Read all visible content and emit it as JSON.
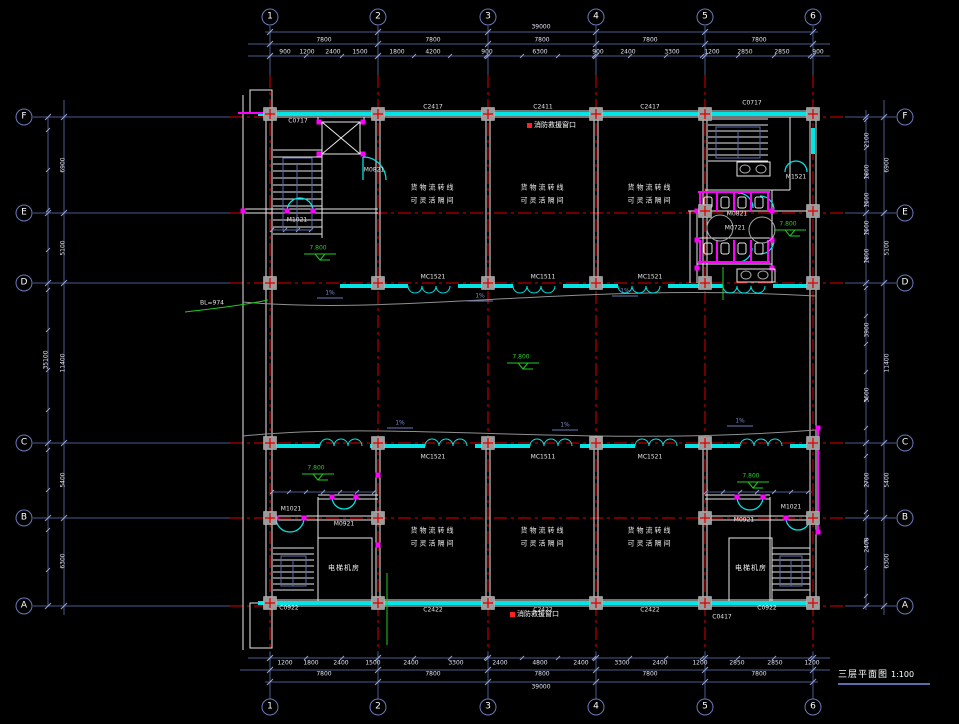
{
  "title": {
    "text": "三层平面图",
    "scale": "1:100"
  },
  "colors": {
    "background": "#000000",
    "grid_line": "#e00000",
    "wall": "#00e5e5",
    "detail": "#e8e8e8",
    "dimension": "#4a5a8e",
    "tick": "#93a3d8",
    "fixture": "#ff00ff",
    "level_mark": "#22cc22",
    "column_fill": "#9c9c9c",
    "rescue": "#ff2222",
    "rail": "#5b6dae",
    "curve": "#909090"
  },
  "grid": {
    "cols": [
      {
        "label": "1",
        "x": 270
      },
      {
        "label": "2",
        "x": 378
      },
      {
        "label": "3",
        "x": 488
      },
      {
        "label": "4",
        "x": 596
      },
      {
        "label": "5",
        "x": 705
      },
      {
        "label": "6",
        "x": 813
      }
    ],
    "rows": [
      {
        "label": "F",
        "y": 117
      },
      {
        "label": "E",
        "y": 213
      },
      {
        "label": "D",
        "y": 283
      },
      {
        "label": "C",
        "y": 443
      },
      {
        "label": "B",
        "y": 518
      },
      {
        "label": "A",
        "y": 606
      }
    ]
  },
  "rooms": [
    {
      "line1": "货物流转线",
      "line2": "可灵活隔间",
      "x": 433,
      "y": 195
    },
    {
      "line1": "货物流转线",
      "line2": "可灵活隔间",
      "x": 543,
      "y": 195
    },
    {
      "line1": "货物流转线",
      "line2": "可灵活隔间",
      "x": 650,
      "y": 195
    },
    {
      "line1": "货物流转线",
      "line2": "可灵活隔间",
      "x": 433,
      "y": 538
    },
    {
      "line1": "货物流转线",
      "line2": "可灵活隔间",
      "x": 543,
      "y": 538
    },
    {
      "line1": "货物流转线",
      "line2": "可灵活隔间",
      "x": 650,
      "y": 538
    }
  ],
  "machine_rooms": [
    {
      "t": "电梯机房",
      "x": 344,
      "y": 568
    },
    {
      "t": "电梯机房",
      "x": 751,
      "y": 568
    }
  ],
  "levels": [
    {
      "t": "7.800",
      "x": 318,
      "y": 248
    },
    {
      "t": "7.800",
      "x": 521,
      "y": 357
    },
    {
      "t": "7.800",
      "x": 788,
      "y": 224
    },
    {
      "t": "7.800",
      "x": 316,
      "y": 468
    },
    {
      "t": "7.800",
      "x": 751,
      "y": 476
    }
  ],
  "slopes": [
    {
      "t": "1%",
      "x": 330,
      "y": 293
    },
    {
      "t": "1%",
      "x": 480,
      "y": 296
    },
    {
      "t": "1%",
      "x": 625,
      "y": 291
    },
    {
      "t": "1%",
      "x": 400,
      "y": 423
    },
    {
      "t": "1%",
      "x": 565,
      "y": 425
    },
    {
      "t": "1%",
      "x": 740,
      "y": 421
    }
  ],
  "window_tags": [
    {
      "t": "C0717",
      "x": 298,
      "y": 121
    },
    {
      "t": "C2417",
      "x": 433,
      "y": 107
    },
    {
      "t": "C2411",
      "x": 543,
      "y": 107
    },
    {
      "t": "C2417",
      "x": 650,
      "y": 107
    },
    {
      "t": "C0717",
      "x": 752,
      "y": 103
    },
    {
      "t": "C0922",
      "x": 289,
      "y": 608
    },
    {
      "t": "C2422",
      "x": 433,
      "y": 610
    },
    {
      "t": "C2422",
      "x": 543,
      "y": 610
    },
    {
      "t": "C2422",
      "x": 650,
      "y": 610
    },
    {
      "t": "C0922",
      "x": 767,
      "y": 608
    },
    {
      "t": "C0417",
      "x": 722,
      "y": 617
    }
  ],
  "door_tags": [
    {
      "t": "M1021",
      "x": 297,
      "y": 220
    },
    {
      "t": "M0821",
      "x": 374,
      "y": 170
    },
    {
      "t": "M1521",
      "x": 796,
      "y": 177
    },
    {
      "t": "M0821",
      "x": 737,
      "y": 214
    },
    {
      "t": "M0721",
      "x": 735,
      "y": 228
    },
    {
      "t": "M1021",
      "x": 291,
      "y": 509
    },
    {
      "t": "M0921",
      "x": 344,
      "y": 524
    },
    {
      "t": "M0921",
      "x": 744,
      "y": 520
    },
    {
      "t": "M1021",
      "x": 791,
      "y": 507
    }
  ],
  "band_tags": [
    {
      "t": "MC1521",
      "x": 433,
      "y": 277
    },
    {
      "t": "MC1511",
      "x": 543,
      "y": 277
    },
    {
      "t": "MC1521",
      "x": 650,
      "y": 277
    },
    {
      "t": "MC1521",
      "x": 433,
      "y": 457
    },
    {
      "t": "MC1511",
      "x": 543,
      "y": 457
    },
    {
      "t": "MC1521",
      "x": 650,
      "y": 457
    }
  ],
  "rescue_windows": [
    {
      "t": "消防救援窗口",
      "x": 527,
      "y": 125
    },
    {
      "t": "消防救援窗口",
      "x": 510,
      "y": 614
    }
  ],
  "misc_labels": [
    {
      "t": "BL=974",
      "x": 212,
      "y": 303
    }
  ],
  "dims": {
    "top_overall": {
      "t": "39000",
      "x": 541,
      "y": 27
    },
    "top_bays": [
      {
        "t": "7800",
        "x": 324,
        "y": 40
      },
      {
        "t": "7800",
        "x": 433,
        "y": 40
      },
      {
        "t": "7800",
        "x": 542,
        "y": 40
      },
      {
        "t": "7800",
        "x": 650,
        "y": 40
      },
      {
        "t": "7800",
        "x": 759,
        "y": 40
      }
    ],
    "top_details": [
      {
        "t": "900",
        "x": 285,
        "y": 52
      },
      {
        "t": "1200",
        "x": 307,
        "y": 52
      },
      {
        "t": "2400",
        "x": 333,
        "y": 52
      },
      {
        "t": "1500",
        "x": 360,
        "y": 52
      },
      {
        "t": "1800",
        "x": 397,
        "y": 52
      },
      {
        "t": "4200",
        "x": 433,
        "y": 52
      },
      {
        "t": "900",
        "x": 487,
        "y": 52
      },
      {
        "t": "6300",
        "x": 540,
        "y": 52
      },
      {
        "t": "900",
        "x": 598,
        "y": 52
      },
      {
        "t": "2400",
        "x": 628,
        "y": 52
      },
      {
        "t": "3300",
        "x": 672,
        "y": 52
      },
      {
        "t": "1200",
        "x": 712,
        "y": 52
      },
      {
        "t": "2850",
        "x": 745,
        "y": 52
      },
      {
        "t": "2850",
        "x": 782,
        "y": 52
      },
      {
        "t": "900",
        "x": 818,
        "y": 52
      }
    ],
    "bottom_details": [
      {
        "t": "1200",
        "x": 285,
        "y": 663
      },
      {
        "t": "1800",
        "x": 311,
        "y": 663
      },
      {
        "t": "2400",
        "x": 341,
        "y": 663
      },
      {
        "t": "1500",
        "x": 373,
        "y": 663
      },
      {
        "t": "2400",
        "x": 411,
        "y": 663
      },
      {
        "t": "3300",
        "x": 456,
        "y": 663
      },
      {
        "t": "2400",
        "x": 500,
        "y": 663
      },
      {
        "t": "4800",
        "x": 540,
        "y": 663
      },
      {
        "t": "2400",
        "x": 581,
        "y": 663
      },
      {
        "t": "3300",
        "x": 622,
        "y": 663
      },
      {
        "t": "2400",
        "x": 660,
        "y": 663
      },
      {
        "t": "1200",
        "x": 700,
        "y": 663
      },
      {
        "t": "2850",
        "x": 737,
        "y": 663
      },
      {
        "t": "2850",
        "x": 775,
        "y": 663
      },
      {
        "t": "1200",
        "x": 812,
        "y": 663
      }
    ],
    "bottom_bays": [
      {
        "t": "7800",
        "x": 324,
        "y": 674
      },
      {
        "t": "7800",
        "x": 433,
        "y": 674
      },
      {
        "t": "7800",
        "x": 542,
        "y": 674
      },
      {
        "t": "7800",
        "x": 650,
        "y": 674
      },
      {
        "t": "7800",
        "x": 759,
        "y": 674
      }
    ],
    "bottom_overall": {
      "t": "39000",
      "x": 541,
      "y": 687
    },
    "left_bays": [
      {
        "t": "6900",
        "x": 63,
        "y": 165
      },
      {
        "t": "5100",
        "x": 63,
        "y": 248
      },
      {
        "t": "11400",
        "x": 63,
        "y": 363
      },
      {
        "t": "5400",
        "x": 63,
        "y": 480
      },
      {
        "t": "6300",
        "x": 63,
        "y": 561
      }
    ],
    "left_overall": {
      "t": "35100",
      "x": 46,
      "y": 360
    },
    "right_bays": [
      {
        "t": "6900",
        "x": 887,
        "y": 165
      },
      {
        "t": "5100",
        "x": 887,
        "y": 248
      },
      {
        "t": "11400",
        "x": 887,
        "y": 363
      },
      {
        "t": "5400",
        "x": 887,
        "y": 480
      },
      {
        "t": "6300",
        "x": 887,
        "y": 561
      }
    ],
    "right_details": [
      {
        "t": "2100",
        "x": 867,
        "y": 140
      },
      {
        "t": "1800",
        "x": 867,
        "y": 172
      },
      {
        "t": "1500",
        "x": 867,
        "y": 200
      },
      {
        "t": "1500",
        "x": 867,
        "y": 228
      },
      {
        "t": "1800",
        "x": 867,
        "y": 256
      },
      {
        "t": "3900",
        "x": 867,
        "y": 330
      },
      {
        "t": "3600",
        "x": 867,
        "y": 395
      },
      {
        "t": "2700",
        "x": 867,
        "y": 480
      },
      {
        "t": "2400",
        "x": 867,
        "y": 545
      }
    ]
  }
}
